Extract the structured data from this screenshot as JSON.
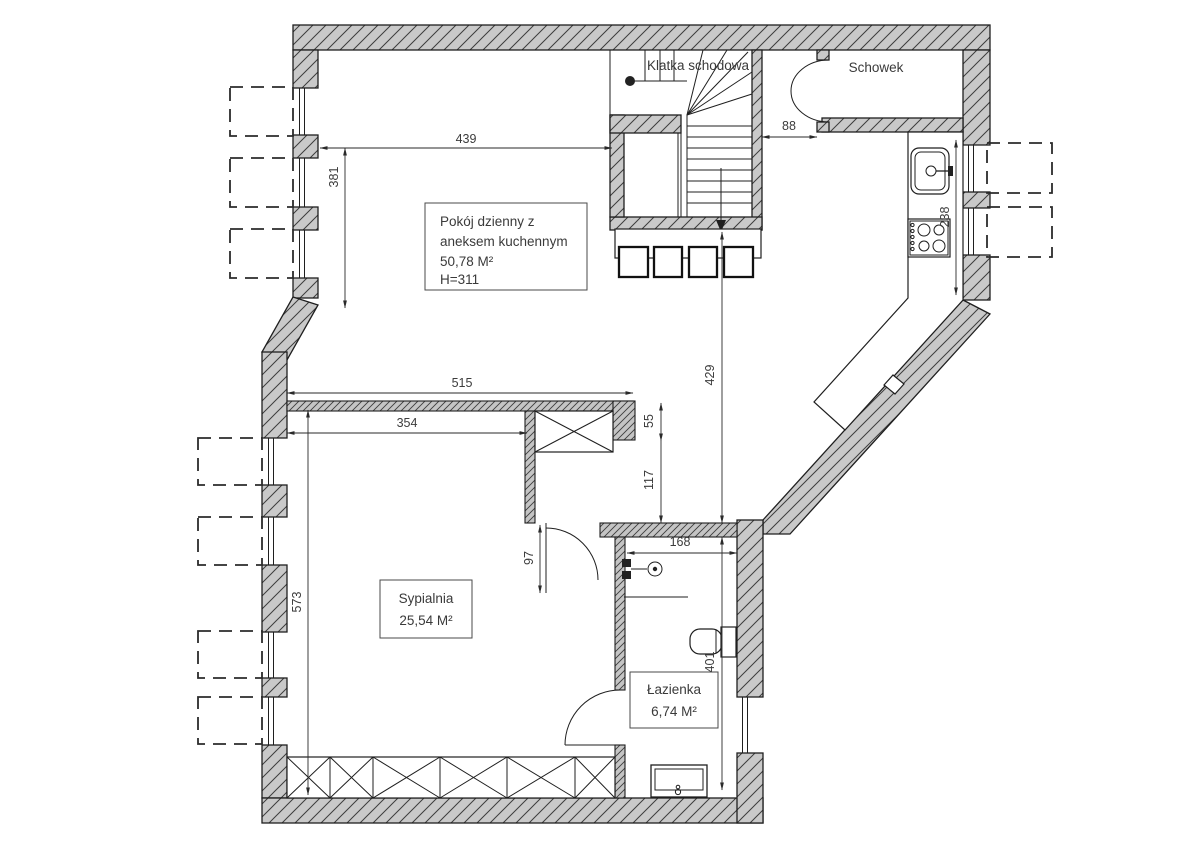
{
  "plan": {
    "rooms": {
      "staircase": {
        "label": "Klatka schodowa"
      },
      "storage": {
        "label": "Schowek"
      },
      "living_room": {
        "label_line1": "Pokój dzienny z",
        "label_line2": "aneksem kuchennym",
        "area": "50,78 M²",
        "height": "H=311"
      },
      "bedroom": {
        "label": "Sypialnia",
        "area": "25,54 M²"
      },
      "bathroom": {
        "label": "Łazienka",
        "area": "6,74 M²"
      }
    },
    "dimensions": {
      "d439": "439",
      "d381": "381",
      "d88": "88",
      "d238": "238",
      "d429": "429",
      "d515": "515",
      "d354": "354",
      "d55": "55",
      "d117": "117",
      "d97": "97",
      "d168": "168",
      "d573": "573",
      "d401": "401"
    },
    "colors": {
      "wall_fill": "#c9c9c9",
      "line": "#1f1f1f",
      "background": "#ffffff"
    }
  }
}
